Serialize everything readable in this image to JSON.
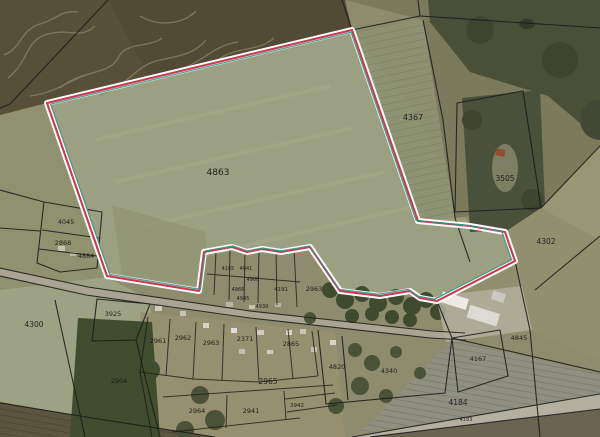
{
  "map": {
    "type": "cadastral-aerial-map",
    "selected_parcel_id": "4863",
    "colors": {
      "highlight_red": "#c93a4c",
      "highlight_white": "#ffffff",
      "highlight_teal": "#3e9186",
      "parcel_line": "#1b1b1b",
      "label": "#161616"
    },
    "parcel_labels": [
      {
        "id": "4863",
        "x": 218,
        "y": 175,
        "size": 9
      },
      {
        "id": "4367",
        "x": 413,
        "y": 120,
        "size": 8
      },
      {
        "id": "3505",
        "x": 505,
        "y": 181,
        "size": 7.5
      },
      {
        "id": "4302",
        "x": 546,
        "y": 244,
        "size": 7.5
      },
      {
        "id": "4045",
        "x": 66,
        "y": 224,
        "size": 6.5
      },
      {
        "id": "2868",
        "x": 63,
        "y": 245,
        "size": 6.5
      },
      {
        "id": "4884",
        "x": 86,
        "y": 258,
        "size": 6.5
      },
      {
        "id": "4300",
        "x": 34,
        "y": 327,
        "size": 7.5
      },
      {
        "id": "3925",
        "x": 113,
        "y": 316,
        "size": 6.5
      },
      {
        "id": "2961",
        "x": 158,
        "y": 343,
        "size": 6.5
      },
      {
        "id": "2962",
        "x": 183,
        "y": 340,
        "size": 6.5
      },
      {
        "id": "2963",
        "x": 211,
        "y": 345,
        "size": 6.5
      },
      {
        "id": "2371",
        "x": 245,
        "y": 341,
        "size": 6.5
      },
      {
        "id": "2865",
        "x": 291,
        "y": 346,
        "size": 6.5
      },
      {
        "id": "2904",
        "x": 119,
        "y": 383,
        "size": 6.5
      },
      {
        "id": "2965",
        "x": 268,
        "y": 384,
        "size": 7.5
      },
      {
        "id": "2964",
        "x": 197,
        "y": 413,
        "size": 6.5
      },
      {
        "id": "2941",
        "x": 251,
        "y": 413,
        "size": 6.5
      },
      {
        "id": "3942",
        "x": 297,
        "y": 407,
        "size": 5.5
      },
      {
        "id": "4820",
        "x": 337,
        "y": 369,
        "size": 6.5
      },
      {
        "id": "4340",
        "x": 389,
        "y": 373,
        "size": 6.5
      },
      {
        "id": "4167",
        "x": 478,
        "y": 361,
        "size": 6.5
      },
      {
        "id": "4845",
        "x": 519,
        "y": 340,
        "size": 6.5
      },
      {
        "id": "4184",
        "x": 458,
        "y": 405,
        "size": 7.5
      },
      {
        "id": "4183",
        "x": 466,
        "y": 421,
        "size": 5
      },
      {
        "id": "4165",
        "x": 228,
        "y": 270,
        "size": 5
      },
      {
        "id": "4941",
        "x": 246,
        "y": 270,
        "size": 5
      },
      {
        "id": "4906",
        "x": 253,
        "y": 281,
        "size": 5
      },
      {
        "id": "4966",
        "x": 238,
        "y": 291,
        "size": 5
      },
      {
        "id": "4191",
        "x": 281,
        "y": 291,
        "size": 5.5
      },
      {
        "id": "2963",
        "x": 314,
        "y": 291,
        "size": 6.5
      },
      {
        "id": "4945",
        "x": 243,
        "y": 300,
        "size": 5
      },
      {
        "id": "4939",
        "x": 262,
        "y": 308,
        "size": 5
      }
    ]
  }
}
